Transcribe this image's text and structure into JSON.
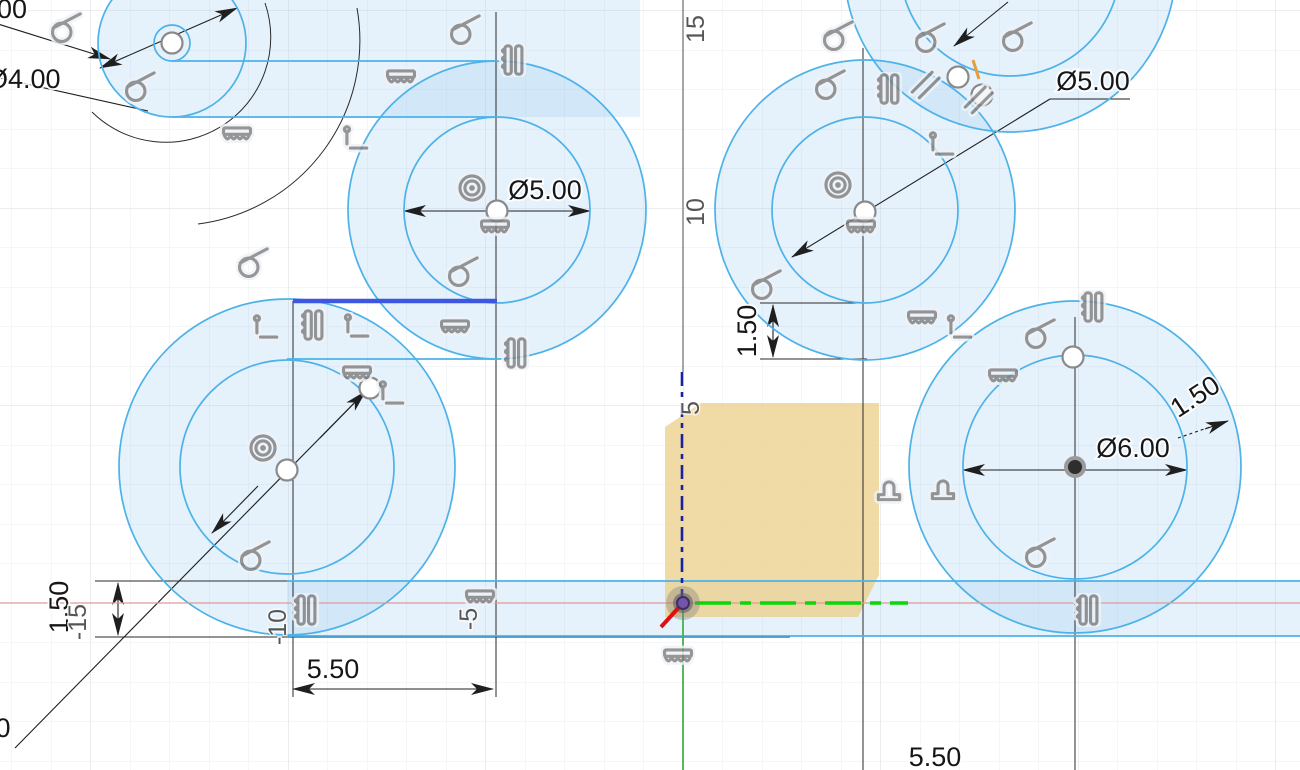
{
  "view": {
    "name": "cad-sketch-canvas",
    "unit_px": 39.5,
    "origin": {
      "x": 683,
      "y": 603
    }
  },
  "colors": {
    "sketch_blue": "#4cb2e8",
    "profile_fill": "#e4eff9",
    "selected_blue": "#3d57e0",
    "selected_dash_blue": "#18239e",
    "highlight_green": "#0ad60a",
    "axis_red": "#e09a9a",
    "axis_green": "#46b14d",
    "selection_orange": "#ecd08c",
    "dimension_black": "#1f1f1f",
    "constraint_gray": "#7f7f7f",
    "origin_purple": "#7456a8"
  },
  "dimensions": {
    "top_left_partial": "00",
    "top_left_diameter": "Ø4.00",
    "middle_diameter": "Ø5.00",
    "top_right_diameter": "Ø5.00",
    "bottom_right_diameter": "Ø6.00",
    "right_band_width": "1.50",
    "middle_band_width": "1.50",
    "left_band_width": "1.50",
    "left_spacing": "5.50",
    "center_spacing": "5.50",
    "bottom_left_partial": "0"
  },
  "ruler": {
    "y": [
      "15",
      "10",
      "5"
    ],
    "x": [
      "-15",
      "-10",
      "-5"
    ]
  },
  "icons": [
    {
      "type": "tangent",
      "x": 66,
      "y": 28
    },
    {
      "type": "tangent",
      "x": 140,
      "y": 87
    },
    {
      "type": "tangent",
      "x": 465,
      "y": 30
    },
    {
      "type": "tangent",
      "x": 253,
      "y": 263
    },
    {
      "type": "tangent",
      "x": 255,
      "y": 556
    },
    {
      "type": "tangent",
      "x": 463,
      "y": 272
    },
    {
      "type": "tangent",
      "x": 766,
      "y": 285
    },
    {
      "type": "tangent",
      "x": 838,
      "y": 36
    },
    {
      "type": "tangent",
      "x": 830,
      "y": 85
    },
    {
      "type": "tangent",
      "x": 930,
      "y": 38
    },
    {
      "type": "tangent",
      "x": 1017,
      "y": 37
    },
    {
      "type": "tangent",
      "x": 1040,
      "y": 334
    },
    {
      "type": "tangent",
      "x": 1040,
      "y": 553
    },
    {
      "type": "fix",
      "x": 237,
      "y": 135
    },
    {
      "type": "fix",
      "x": 401,
      "y": 78
    },
    {
      "type": "fix",
      "x": 495,
      "y": 228
    },
    {
      "type": "fix",
      "x": 455,
      "y": 328
    },
    {
      "type": "fix",
      "x": 861,
      "y": 228
    },
    {
      "type": "fix",
      "x": 922,
      "y": 319
    },
    {
      "type": "fix",
      "x": 1003,
      "y": 377
    },
    {
      "type": "fix",
      "x": 480,
      "y": 598
    },
    {
      "type": "fix",
      "x": 678,
      "y": 657
    },
    {
      "type": "fix",
      "x": 357,
      "y": 374
    },
    {
      "type": "concentric",
      "x": 472,
      "y": 188
    },
    {
      "type": "concentric",
      "x": 838,
      "y": 185
    },
    {
      "type": "concentric",
      "x": 263,
      "y": 448
    },
    {
      "type": "collinear",
      "x": 512,
      "y": 60
    },
    {
      "type": "collinear",
      "x": 515,
      "y": 353
    },
    {
      "type": "collinear",
      "x": 305,
      "y": 610
    },
    {
      "type": "collinear",
      "x": 1092,
      "y": 307
    },
    {
      "type": "collinear",
      "x": 1087,
      "y": 610
    },
    {
      "type": "collinear",
      "x": 888,
      "y": 89
    },
    {
      "type": "collinear",
      "x": 312,
      "y": 325
    },
    {
      "type": "perpendicular",
      "x": 354,
      "y": 141
    },
    {
      "type": "perpendicular",
      "x": 264,
      "y": 330
    },
    {
      "type": "perpendicular",
      "x": 355,
      "y": 329
    },
    {
      "type": "perpendicular",
      "x": 940,
      "y": 147
    },
    {
      "type": "perpendicular",
      "x": 958,
      "y": 330
    },
    {
      "type": "perpendicular",
      "x": 390,
      "y": 396
    },
    {
      "type": "parallel",
      "x": 925,
      "y": 85
    },
    {
      "type": "parallel",
      "x": 978,
      "y": 100
    },
    {
      "type": "midpoint",
      "x": 889,
      "y": 489
    },
    {
      "type": "midpoint",
      "x": 943,
      "y": 488
    }
  ],
  "points": [
    {
      "kind": "handle",
      "x": 172,
      "y": 43
    },
    {
      "kind": "handle",
      "x": 497,
      "y": 211
    },
    {
      "kind": "handle",
      "x": 865,
      "y": 212
    },
    {
      "kind": "handle",
      "x": 958,
      "y": 77
    },
    {
      "kind": "handle",
      "x": 982,
      "y": 95
    },
    {
      "kind": "handle",
      "x": 287,
      "y": 470
    },
    {
      "kind": "handle",
      "x": 370,
      "y": 388
    },
    {
      "kind": "handle",
      "x": 1073,
      "y": 357
    },
    {
      "kind": "center",
      "x": 1075,
      "y": 467
    }
  ]
}
